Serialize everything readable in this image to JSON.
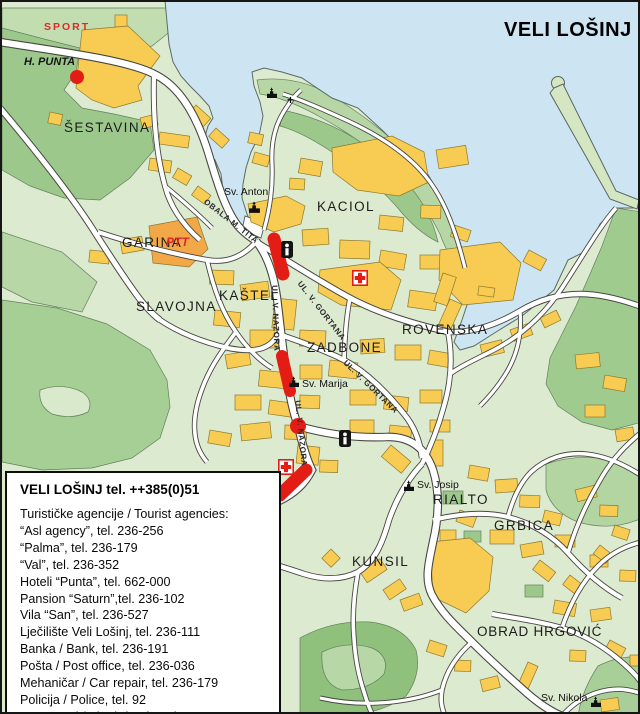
{
  "map_title": "VELI LOŠINJ",
  "info_box": {
    "title": "VELI LOŠINJ tel. ++385(0)51",
    "lines": [
      "Turističke agencije / Tourist agencies:",
      "“Asl agency”, tel. 236-256",
      "“Palma”, tel. 236-179",
      "“Val”, tel. 236-352",
      "Hoteli “Punta”, tel. 662-000",
      "Pansion “Saturn”,tel. 236-102",
      "Vila “San”, tel. 236-527",
      "Lječilište Veli Lošinj, tel. 236-111",
      "Banka / Bank, tel. 236-191",
      "Pošta / Post office, tel. 236-036",
      "Mehaničar / Car repair, tel. 236-179",
      "Policija / Police, tel. 92",
      "Vatrogasci / Fire brigade, tel. 93"
    ]
  },
  "districts": {
    "sestavina": "ŠESTAVINA",
    "kaciol": "KACIOL",
    "garina": "GARINA",
    "slavojna": "SLAVOJNA",
    "kastel": "KAŠTEL",
    "zadbone": "ZADBONE",
    "rovenska": "ROVENSKA",
    "rialto": "RIALTO",
    "grbica": "GRBICA",
    "kunsil": "KUNSIL",
    "obrad_hrgovic": "OBRAD HRGOVIĆ"
  },
  "churches": {
    "sv_anton": "Sv. Anton",
    "sv_marija": "Sv. Marija",
    "sv_josip": "Sv. Josip",
    "sv_nikola": "Sv. Nikola"
  },
  "streets": {
    "obala": "OBALA M. TITA",
    "nazora": "UL. V. NAZORA",
    "gortana": "UL. V. GORTANA"
  },
  "pois": {
    "sport": "SPORT",
    "punta": "H. PUNTA",
    "ptt": "PTT"
  },
  "colors": {
    "water": "#cde5f2",
    "land": "#dcead0",
    "vegetation": "#a4cd93",
    "building": "#f8cb52",
    "building_orange": "#f2a846",
    "route_red": "#e31d16"
  }
}
